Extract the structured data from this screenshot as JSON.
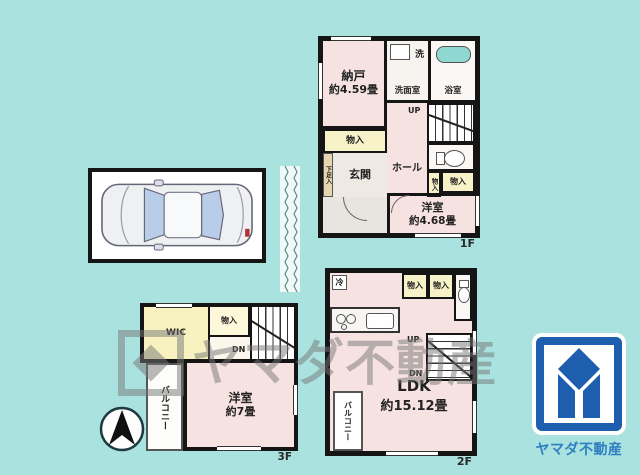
{
  "colors": {
    "background": "#a9e2df",
    "room_pink": "#f6e3e1",
    "closet_yellow": "#f8f2c8",
    "wall_black": "#151515",
    "bathtub_cyan": "#8fd8d2",
    "logo_blue": "#1d5fae",
    "logo_text_blue": "#2e7fc0",
    "watermark_gray": "#777777"
  },
  "icons": {
    "car": "top-view-car-illustration",
    "north_arrow": "compass-arrow-up",
    "bathtub": "rounded-tub-shape",
    "toilet": "toilet-bowl-shape",
    "sink": "basin-rectangle",
    "stove": "burner-circles",
    "break_line": "zigzag-separator",
    "logo_mark": "yamada-diamond-mark"
  },
  "floor1": {
    "floor_label": "1F",
    "nando": {
      "name": "納戸",
      "size": "約4.59畳"
    },
    "senmenshitsu": "洗面室",
    "laundry_mark": "洗",
    "yokushitsu": "浴室",
    "up_label": "UP",
    "closet_left": "物入",
    "shoe_cabinet": "下足入",
    "genkan": "玄関",
    "hall": "ホール",
    "closet_small": "物入",
    "closet_right": "物入",
    "yoshitsu": {
      "name": "洋室",
      "size": "約4.68畳"
    }
  },
  "floor2": {
    "floor_label": "2F",
    "fridge_mark": "冷",
    "closet_a": "物入",
    "closet_b": "物入",
    "up_label": "UP",
    "down_label": "DN",
    "ldk": {
      "name": "LDK",
      "size": "約15.12畳"
    },
    "balcony": "バルコニー"
  },
  "floor3": {
    "floor_label": "3F",
    "wic": "WIC",
    "closet": "物入",
    "down_label": "DN",
    "yoshitsu": {
      "name": "洋室",
      "size": "約7畳"
    },
    "balcony": "バルコニー"
  },
  "watermark": {
    "text": "ヤマダ不動産"
  },
  "logo": {
    "company": "ヤマダ不動産"
  }
}
